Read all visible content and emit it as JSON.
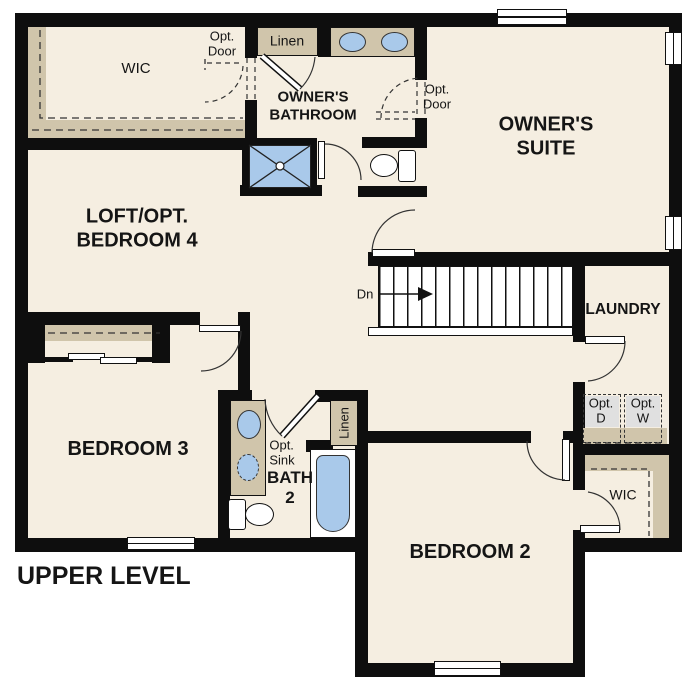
{
  "title": "UPPER LEVEL",
  "rooms": {
    "wic_owners": {
      "label": "WIC"
    },
    "owners_bathroom": {
      "label": "OWNER'S\nBATHROOM"
    },
    "owners_suite": {
      "label": "OWNER'S\nSUITE"
    },
    "loft": {
      "label": "LOFT/OPT.\nBEDROOM 4"
    },
    "laundry": {
      "label": "LAUNDRY"
    },
    "bedroom3": {
      "label": "BEDROOM 3"
    },
    "bath2": {
      "label": "BATH\n2"
    },
    "bedroom2": {
      "label": "BEDROOM 2"
    },
    "wic_bedroom2": {
      "label": "WIC"
    }
  },
  "closets": {
    "linen_hall": {
      "label": "Linen"
    },
    "linen_bath": {
      "label": "Linen"
    }
  },
  "annotations": {
    "opt_door_wic": {
      "label": "Opt.\nDoor"
    },
    "opt_door_suite": {
      "label": "Opt.\nDoor"
    },
    "opt_sink": {
      "label": "Opt.\nSink"
    },
    "opt_dryer": {
      "label": "Opt.\nD"
    },
    "opt_washer": {
      "label": "Opt.\nW"
    },
    "stairs_down": {
      "label": "Dn"
    }
  },
  "fixtures": [
    "shower",
    "bathtub",
    "toilet",
    "double-vanity-sink",
    "vanity-sink",
    "optional-sink",
    "optional-dryer",
    "optional-washer",
    "stairs-down",
    "bypass-closet-doors",
    "windows",
    "hinged-doors"
  ],
  "colors": {
    "wall": "#0e0e0e",
    "floor": "#f5eee1",
    "casework_tan": "#d0c5ab",
    "fixture_blue": "#a9c9ea",
    "appliance_gray": "#e0e0e0",
    "background": "#ffffff"
  }
}
